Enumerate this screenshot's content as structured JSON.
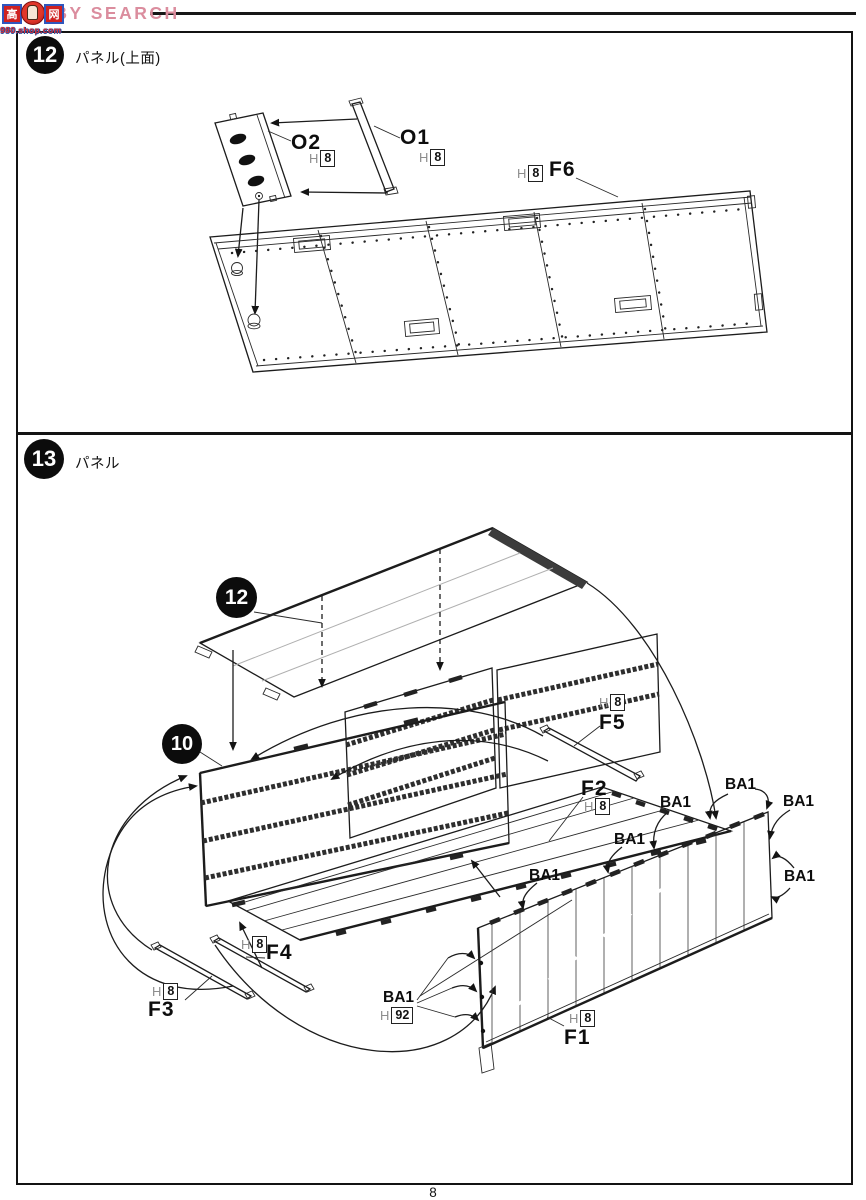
{
  "watermark": {
    "brand": "HOBBY SEARCH",
    "logo": {
      "left_char": "高",
      "right_char": "网",
      "subtext": "980.shop.com"
    }
  },
  "page": {
    "number": "8"
  },
  "step12": {
    "number": "12",
    "title": "パネル(上面)",
    "parts": {
      "o2": {
        "id": "O2",
        "grade": "H",
        "runner": "8"
      },
      "o1": {
        "id": "O1",
        "grade": "H",
        "runner": "8"
      },
      "f6": {
        "id": "F6",
        "grade": "H",
        "runner": "8"
      }
    }
  },
  "step13": {
    "number": "13",
    "title": "パネル",
    "callouts": {
      "panel12": "12",
      "panel10": "10"
    },
    "ba1_label": "BA1",
    "parts": {
      "f5": {
        "id": "F5",
        "grade": "H",
        "runner": "8"
      },
      "f2": {
        "id": "F2",
        "grade": "H",
        "runner": "8"
      },
      "f4": {
        "id": "F4",
        "grade": "H",
        "runner": "8"
      },
      "f3": {
        "id": "F3",
        "grade": "H",
        "runner": "8"
      },
      "f1": {
        "id": "F1",
        "grade": "H",
        "runner": "8"
      },
      "ba1": {
        "id": "BA1",
        "grade": "H",
        "runner": "92"
      }
    }
  }
}
